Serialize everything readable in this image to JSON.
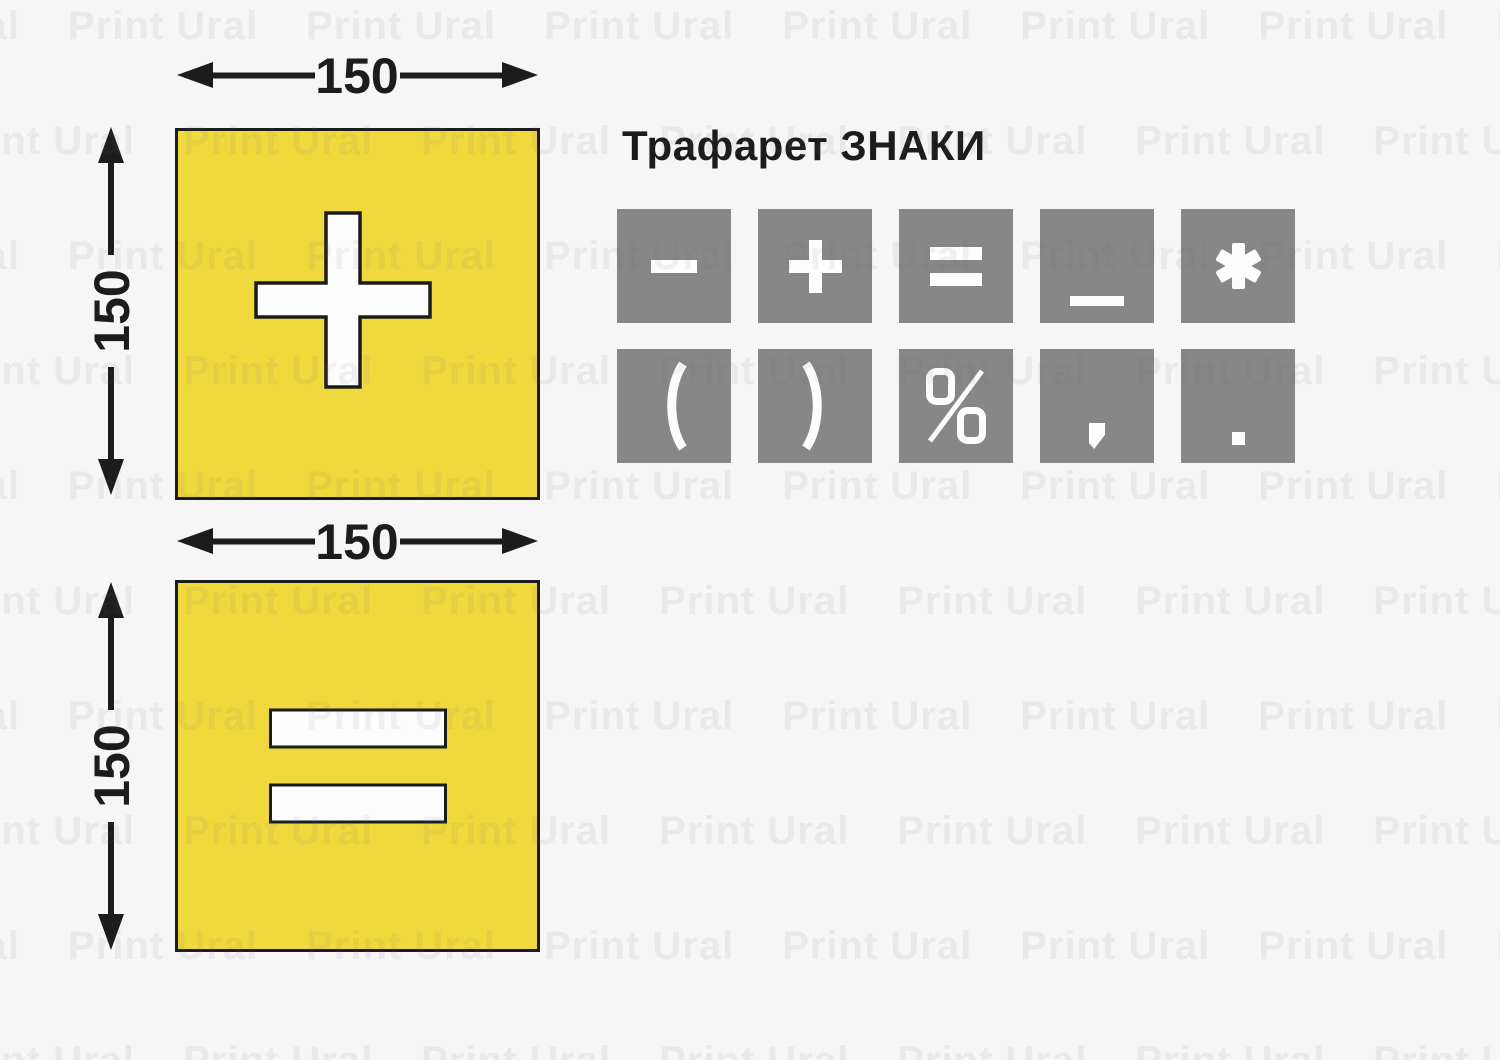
{
  "title": "Трафарет ЗНАКИ",
  "watermark": {
    "text": "Print Ural"
  },
  "colors": {
    "background": "#f6f6f7",
    "stencil_yellow": "#efd93c",
    "outline_black": "#1c1c1c",
    "tile_gray": "#878787",
    "symbol_white": "#fdfdfd"
  },
  "stencils": [
    {
      "name": "plus-stencil",
      "symbol": "plus",
      "width_label": "150",
      "height_label": "150"
    },
    {
      "name": "equals-stencil",
      "symbol": "equals",
      "width_label": "150",
      "height_label": "150"
    }
  ],
  "sign_tiles": {
    "row1": [
      "minus",
      "plus",
      "equals",
      "underscore",
      "asterisk"
    ],
    "row2": [
      "open-paren",
      "close-paren",
      "percent",
      "comma",
      "period"
    ]
  }
}
